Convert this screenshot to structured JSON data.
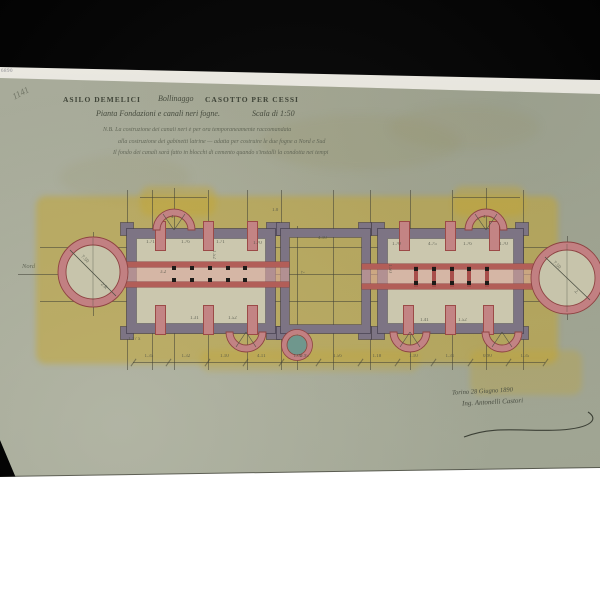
{
  "photo": {
    "background": "#060606",
    "bottom_fill": "#ffffff"
  },
  "labels": {
    "archive_number": "6890",
    "pencil_mark": "1141",
    "north": "Nord"
  },
  "title_block": {
    "line1_left": "ASILO DEMELICI",
    "line1_mid": "Bollinaggo",
    "line1_right": "CASOTTO PER CESSI",
    "line2": "Pianta Fondazioni e canali neri fogne.",
    "scale": "Scala di 1:50",
    "nb_line1": "N.B.  La costruzione dei canali neri è per ora temporaneamente raccomandata",
    "nb_line2": "alla costruzione dei gabinetti latrine — adatta per costruire le due fogne a Nord e Sud",
    "nb_line3": "Il fondo dei canali sarà fatto in blocchi di cemento quando s'installi la condotta nei tempi"
  },
  "signature": {
    "date_line": "Torino 28 Giugno 1890",
    "name_line": "Ing. Antonelli Castori"
  },
  "colors": {
    "paper": "#a7aa98",
    "wash": "#c6a93c",
    "wall": "#7d7484",
    "wall_dark": "#555060",
    "masonry": "#c28384",
    "masonry_dark": "#8e4342",
    "well": "#6f978d",
    "ink": "#4c5044"
  },
  "dimension_chain": {
    "y": 362,
    "tick_x": [
      133,
      168,
      207,
      245,
      281,
      318,
      360,
      397,
      433,
      470,
      508,
      545
    ],
    "labels": [
      "1.35",
      "1.32",
      "1.10",
      "4.11",
      "1.02",
      "1.56",
      "1.18",
      "1.10",
      "1.31",
      "0.90",
      "1.35"
    ]
  },
  "grid": {
    "verticals": [
      {
        "x": 93,
        "y1": 232,
        "y2": 316
      },
      {
        "x": 127,
        "y1": 190,
        "y2": 370
      },
      {
        "x": 152,
        "y1": 190,
        "y2": 370
      },
      {
        "x": 174,
        "y1": 188,
        "y2": 370
      },
      {
        "x": 208,
        "y1": 190,
        "y2": 370
      },
      {
        "x": 247,
        "y1": 190,
        "y2": 370
      },
      {
        "x": 281,
        "y1": 190,
        "y2": 370
      },
      {
        "x": 297,
        "y1": 226,
        "y2": 370
      },
      {
        "x": 333,
        "y1": 190,
        "y2": 370
      },
      {
        "x": 370,
        "y1": 190,
        "y2": 370
      },
      {
        "x": 410,
        "y1": 190,
        "y2": 370
      },
      {
        "x": 452,
        "y1": 190,
        "y2": 370
      },
      {
        "x": 486,
        "y1": 188,
        "y2": 370
      },
      {
        "x": 523,
        "y1": 190,
        "y2": 370
      },
      {
        "x": 567,
        "y1": 236,
        "y2": 320
      }
    ],
    "horizontals": [
      {
        "y": 274,
        "x1": 18,
        "x2": 600
      },
      {
        "y": 247,
        "x1": 40,
        "x2": 562
      },
      {
        "y": 301,
        "x1": 40,
        "x2": 562
      },
      {
        "y": 197,
        "x1": 140,
        "x2": 207
      },
      {
        "y": 197,
        "x1": 453,
        "x2": 520
      }
    ]
  },
  "annotations": [
    {
      "x": 146,
      "y": 240,
      "text": "1.71",
      "rot": 0
    },
    {
      "x": 181,
      "y": 240,
      "text": "1.76",
      "rot": 0
    },
    {
      "x": 216,
      "y": 240,
      "text": "1.71",
      "rot": 0
    },
    {
      "x": 253,
      "y": 241,
      "text": "1.70",
      "rot": 0
    },
    {
      "x": 190,
      "y": 316,
      "text": "1.31",
      "rot": 0
    },
    {
      "x": 228,
      "y": 316,
      "text": "1.52",
      "rot": 0
    },
    {
      "x": 209,
      "y": 252,
      "text": "1.52",
      "rot": 90
    },
    {
      "x": 385,
      "y": 266,
      "text": "1.50",
      "rot": 90
    },
    {
      "x": 300,
      "y": 270,
      "text": "2.",
      "rot": 90
    },
    {
      "x": 318,
      "y": 236,
      "text": "4.10",
      "rot": 0
    },
    {
      "x": 392,
      "y": 242,
      "text": "1.70",
      "rot": 0
    },
    {
      "x": 428,
      "y": 242,
      "text": "4.75",
      "rot": 0
    },
    {
      "x": 463,
      "y": 242,
      "text": "1.76",
      "rot": 0
    },
    {
      "x": 499,
      "y": 242,
      "text": "1.70",
      "rot": 0
    },
    {
      "x": 420,
      "y": 318,
      "text": "1.41",
      "rot": 0
    },
    {
      "x": 458,
      "y": 318,
      "text": "1.52",
      "rot": 0
    },
    {
      "x": 80,
      "y": 257,
      "text": "7.50",
      "rot": 45
    },
    {
      "x": 100,
      "y": 284,
      "text": "2.R",
      "rot": 45
    },
    {
      "x": 552,
      "y": 263,
      "text": "7.50",
      "rot": 45
    },
    {
      "x": 574,
      "y": 290,
      "text": "2.",
      "rot": 45
    },
    {
      "x": 171,
      "y": 215,
      "text": "4",
      "rot": 0
    },
    {
      "x": 483,
      "y": 215,
      "text": "4",
      "rot": 0
    },
    {
      "x": 160,
      "y": 270,
      "text": "3.2",
      "rot": 0
    },
    {
      "x": 300,
      "y": 354,
      "text": "0.95",
      "rot": 0
    },
    {
      "x": 128,
      "y": 337,
      "text": "1.17 x",
      "rot": 0
    },
    {
      "x": 272,
      "y": 208,
      "text": "1.0",
      "rot": 0
    }
  ]
}
